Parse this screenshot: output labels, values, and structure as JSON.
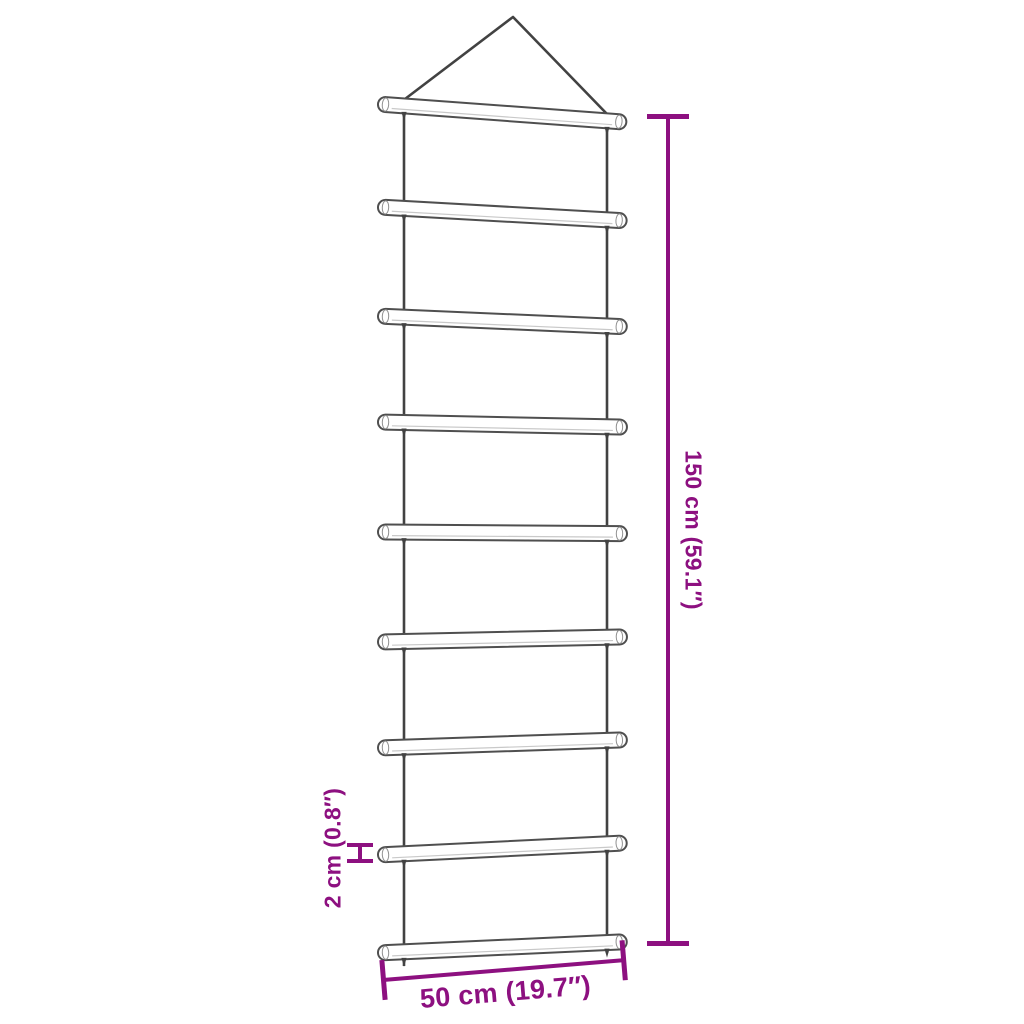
{
  "page": {
    "background": "#ffffff",
    "subject": "hanging rope ladder with 9 wooden rungs (dimension diagram)"
  },
  "colors": {
    "dimension": "#8d1080",
    "rope": "#424242",
    "rung_stroke": "#4f4f4f",
    "rung_fill": "#ffffff",
    "rung_shade": "#c9c9c9",
    "rung_cap": "#909090"
  },
  "dimensions": {
    "height": {
      "label": "150 cm (59.1″)"
    },
    "thickness": {
      "label": "2 cm (0.8″)"
    },
    "width": {
      "label": "50 cm (19.7″)"
    }
  },
  "figure": {
    "triangle": {
      "apex": [
        513,
        17
      ],
      "left_foot": [
        405,
        99
      ],
      "right_foot": [
        607,
        114
      ]
    },
    "ropes": [
      {
        "name": "rope-left",
        "x": 404,
        "y1": 99,
        "y2": 966
      },
      {
        "name": "rope-right",
        "x": 607,
        "y1": 114,
        "y2": 953
      }
    ],
    "rungs": {
      "x": 378,
      "length": 249,
      "thickness": 15,
      "items": [
        {
          "cy": 104,
          "rot": 4.2
        },
        {
          "cy": 207,
          "rot": 3.2
        },
        {
          "cy": 316,
          "rot": 2.5
        },
        {
          "cy": 422,
          "rot": 1.2
        },
        {
          "cy": 532,
          "rot": 0.4
        },
        {
          "cy": 642,
          "rot": -1.2
        },
        {
          "cy": 748,
          "rot": -1.9
        },
        {
          "cy": 855,
          "rot": -2.8
        },
        {
          "cy": 953,
          "rot": -2.6
        }
      ]
    }
  }
}
